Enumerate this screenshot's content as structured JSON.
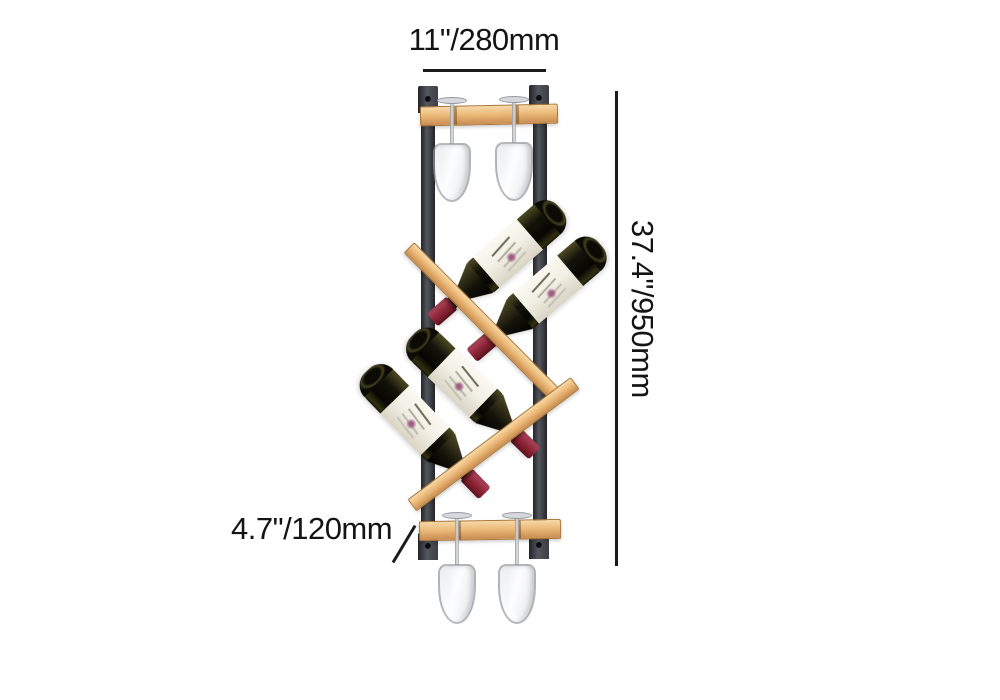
{
  "image": {
    "type": "product dimension photo",
    "subject": "wall-mounted wood and metal wine rack holding 4 tilted wine bottles and 4 hanging stemware glasses",
    "bottle_count": 4,
    "glass_count": 4
  },
  "annotations": {
    "width_label": "11\"/280mm",
    "height_label": "37.4\"/950mm",
    "depth_label": "4.7\"/120mm"
  },
  "theme": {
    "background": "#ffffff",
    "metal": "#3c3e44",
    "metal_dark": "#222428",
    "metal_light": "#53565e",
    "wood": "#eab877",
    "wood_light": "#f7d9a8",
    "wood_dark": "#cd9356",
    "wood_edge": "#aa763c",
    "bottle_glass": "#14130a",
    "bottle_glass_light": "#4e4a24",
    "bottle_label": "#f3f0e6",
    "bottle_cap": "#8d2437",
    "bottle_cap_light": "#b04a5e",
    "bottle_cap_dark": "#61141f",
    "glassware_line": "#888b92",
    "glassware_fill": "#d8dbe1",
    "dim_line": "#1b1b1b",
    "dim_text": "#141414"
  }
}
